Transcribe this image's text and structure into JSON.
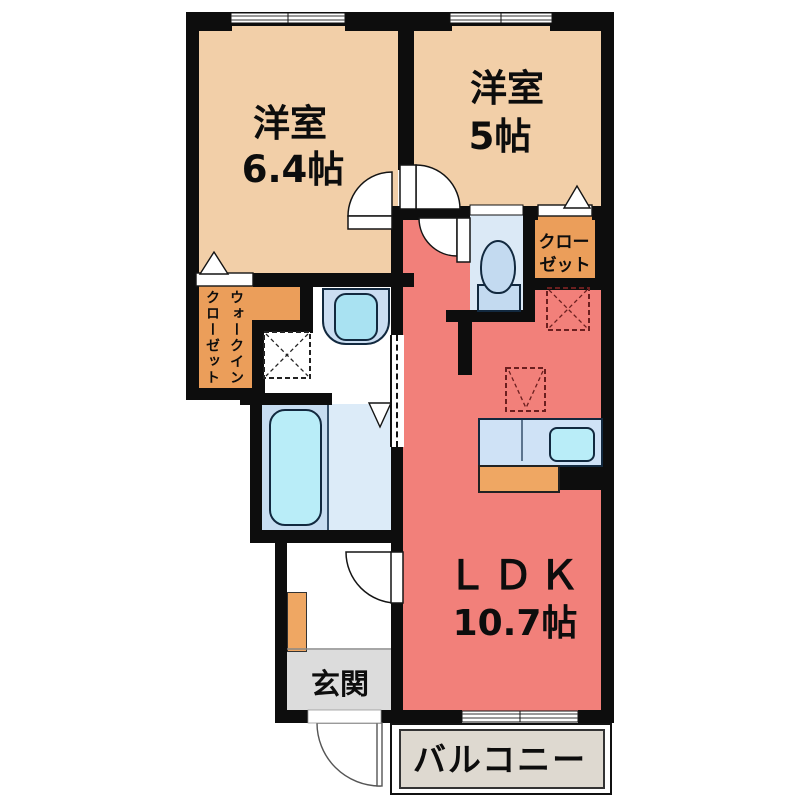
{
  "page": {
    "type": "apartment-floorplan",
    "background": "#ffffff"
  },
  "rooms": {
    "bedroom1": {
      "name": "洋室",
      "size": "6.4帖"
    },
    "bedroom2": {
      "name": "洋室",
      "size": "5帖"
    },
    "ldk": {
      "name": "ＬＤＫ",
      "size": "10.7帖"
    },
    "closet": {
      "name": "クローゼット",
      "line1": "クロー",
      "line2": "ゼット"
    },
    "walk_in_closet": {
      "name": "ウォークインクローゼット",
      "col1": "ウォークイン",
      "col2": "クローゼット"
    },
    "entrance": {
      "name": "玄関"
    },
    "balcony": {
      "name": "バルコニー"
    }
  },
  "fixtures": [
    "bathtub",
    "washbasin",
    "toilet",
    "kitchen-counter",
    "kitchen-sink",
    "washing-machine-space",
    "refrigerator-space",
    "shoe-cabinet",
    "sliding-door",
    "hinged-door",
    "folding-door",
    "sliding-window"
  ],
  "colors": {
    "wall": "#0d0d0d",
    "bedroom_peach": "#f2cfa8",
    "closet_orange": "#eb9e5a",
    "ldk_red": "#f2807a",
    "wet_area_blue": "#dbe9f6",
    "bath_floor_blue": "#c7ddf1",
    "fixture_cyan": "#b9edf8",
    "counter_blue": "#cfe2f6",
    "genkan_gray": "#dcdcdc",
    "balcony_gray": "#ded9d0",
    "symbol_dark_red": "#6b1f1f"
  }
}
